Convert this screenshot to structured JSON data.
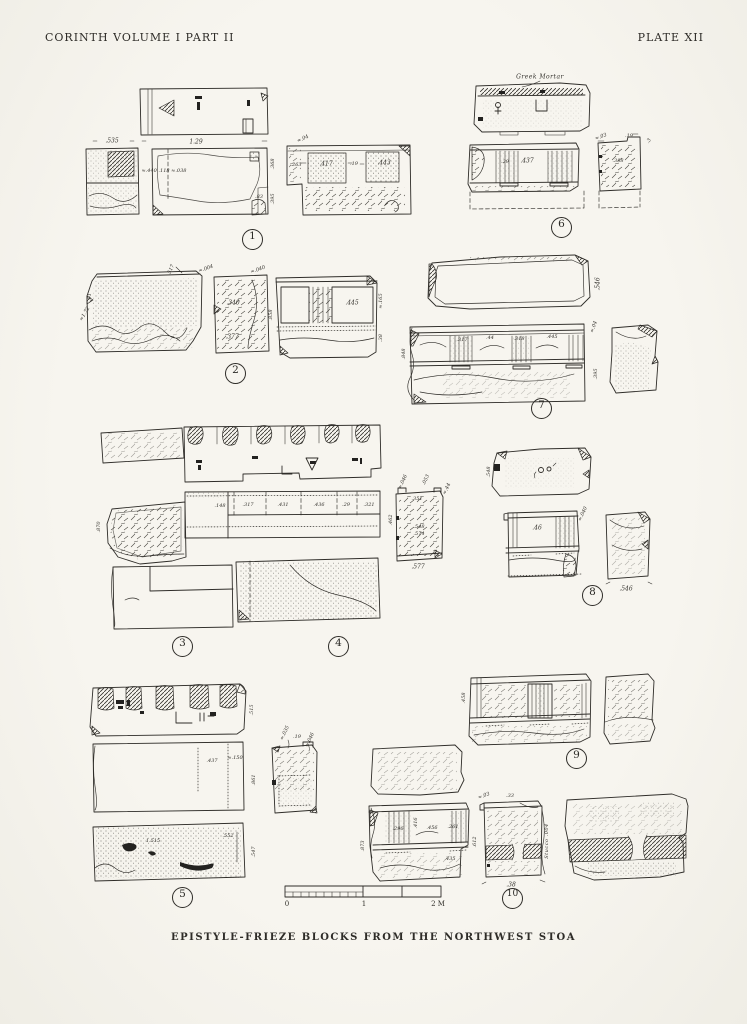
{
  "page": {
    "header_left": "CORINTH   VOLUME I   PART II",
    "header_right": "PLATE XII",
    "caption": "EPISTYLE-FRIEZE BLOCKS FROM THE NORTHWEST STOA"
  },
  "figures": [
    {
      "number": "1",
      "circle": {
        "x": 252,
        "y": 239
      },
      "labels": [
        {
          "t": ".535",
          "x": 112,
          "y": 141
        },
        {
          "t": "1.29",
          "x": 196,
          "y": 142
        },
        {
          "t": "≈.440 .118 ≈.038",
          "x": 164,
          "y": 171,
          "s": 5
        },
        {
          "t": ".83",
          "x": 259,
          "y": 197,
          "s": 5
        },
        {
          "t": ".368",
          "x": 273,
          "y": 164,
          "r": -90,
          "s": 5
        },
        {
          "t": ".395",
          "x": 273,
          "y": 199,
          "r": -90,
          "s": 5
        },
        {
          "t": "≈.04",
          "x": 303,
          "y": 139,
          "r": -25,
          "s": 5
        },
        {
          "t": ".263",
          "x": 296,
          "y": 165,
          "s": 5
        },
        {
          "t": ".417",
          "x": 326,
          "y": 164
        },
        {
          "t": ".19",
          "x": 354,
          "y": 164,
          "s": 5
        },
        {
          "t": ".443",
          "x": 384,
          "y": 163
        }
      ]
    },
    {
      "number": "2",
      "circle": {
        "x": 235,
        "y": 373
      },
      "labels": [
        {
          "t": ".517",
          "x": 171,
          "y": 270,
          "r": -65,
          "s": 5
        },
        {
          "t": ".91",
          "x": 90,
          "y": 297,
          "r": -90,
          "s": 5
        },
        {
          "t": "≈1.72",
          "x": 85,
          "y": 314,
          "r": -60,
          "s": 5
        },
        {
          "t": "≈.004",
          "x": 206,
          "y": 269,
          "r": -20,
          "s": 5
        },
        {
          "t": "≈.040",
          "x": 258,
          "y": 270,
          "r": -20,
          "s": 5
        },
        {
          "t": ".340",
          "x": 233,
          "y": 303
        },
        {
          "t": ".377",
          "x": 232,
          "y": 337
        },
        {
          "t": ".445",
          "x": 352,
          "y": 303
        },
        {
          "t": ".858",
          "x": 271,
          "y": 315,
          "r": -90,
          "s": 5
        },
        {
          "t": "≈.165",
          "x": 381,
          "y": 301,
          "r": -90,
          "s": 5
        },
        {
          "t": ".38",
          "x": 381,
          "y": 338,
          "r": -90,
          "s": 5
        }
      ]
    },
    {
      "number": "3",
      "circle": {
        "x": 182,
        "y": 646
      },
      "labels": [
        {
          "t": ".148",
          "x": 220,
          "y": 506,
          "s": 5
        },
        {
          "t": ".317",
          "x": 248,
          "y": 505,
          "s": 5
        },
        {
          "t": ".431",
          "x": 283,
          "y": 505,
          "s": 5
        },
        {
          "t": ".436",
          "x": 319,
          "y": 505,
          "s": 5
        },
        {
          "t": ".29",
          "x": 346,
          "y": 505,
          "s": 5
        },
        {
          "t": ".321",
          "x": 369,
          "y": 505,
          "s": 5
        },
        {
          "t": ".870",
          "x": 99,
          "y": 527,
          "r": -90,
          "s": 5
        }
      ]
    },
    {
      "number": "4",
      "circle": {
        "x": 338,
        "y": 646
      },
      "labels": [
        {
          "t": "≈.046",
          "x": 403,
          "y": 482,
          "r": -65,
          "s": 5
        },
        {
          "t": ".053",
          "x": 426,
          "y": 480,
          "r": -65,
          "s": 5
        },
        {
          "t": "≈.44",
          "x": 447,
          "y": 489,
          "r": -65,
          "s": 5
        },
        {
          "t": ".351",
          "x": 417,
          "y": 499,
          "s": 5
        },
        {
          "t": ".548",
          "x": 419,
          "y": 527,
          "s": 5
        },
        {
          "t": ".574",
          "x": 419,
          "y": 534,
          "s": 5
        },
        {
          "t": ".462",
          "x": 391,
          "y": 520,
          "r": -90,
          "s": 5
        },
        {
          "t": ".577",
          "x": 418,
          "y": 567
        }
      ]
    },
    {
      "number": "5",
      "circle": {
        "x": 182,
        "y": 897
      },
      "labels": [
        {
          "t": ".515",
          "x": 252,
          "y": 710,
          "r": -90,
          "s": 5
        },
        {
          "t": ".437",
          "x": 212,
          "y": 761,
          "s": 5
        },
        {
          "t": "≈.150",
          "x": 235,
          "y": 758,
          "s": 5
        },
        {
          "t": ".861",
          "x": 254,
          "y": 780,
          "r": -90,
          "s": 5
        },
        {
          "t": "1.515",
          "x": 153,
          "y": 841,
          "s": 5
        },
        {
          "t": ".552",
          "x": 228,
          "y": 836,
          "s": 5
        },
        {
          "t": ".547",
          "x": 254,
          "y": 852,
          "r": -90,
          "s": 5
        },
        {
          "t": "≈.035",
          "x": 285,
          "y": 733,
          "r": -65,
          "s": 5
        },
        {
          "t": ".19",
          "x": 297,
          "y": 737,
          "s": 5
        },
        {
          "t": "≈.046",
          "x": 310,
          "y": 740,
          "r": -65,
          "s": 5
        }
      ]
    },
    {
      "number": "6",
      "circle": {
        "x": 561,
        "y": 227
      },
      "labels": [
        {
          "t": "Greek Mortar",
          "x": 540,
          "y": 77,
          "s": 6,
          "c": "cursive"
        },
        {
          "t": ".29",
          "x": 505,
          "y": 162,
          "s": 5
        },
        {
          "t": ".437",
          "x": 527,
          "y": 161
        },
        {
          "t": "≈.03",
          "x": 601,
          "y": 137,
          "r": -20,
          "s": 5
        },
        {
          "t": ".19",
          "x": 629,
          "y": 136,
          "s": 5
        },
        {
          "t": ".3",
          "x": 649,
          "y": 141,
          "r": -60,
          "s": 5
        },
        {
          "t": ".388",
          "x": 618,
          "y": 161,
          "s": 5
        }
      ]
    },
    {
      "number": "7",
      "circle": {
        "x": 541,
        "y": 408
      },
      "labels": [
        {
          "t": ".546",
          "x": 598,
          "y": 284,
          "r": -90
        },
        {
          "t": ".317",
          "x": 462,
          "y": 340,
          "s": 5
        },
        {
          "t": ".44",
          "x": 490,
          "y": 338,
          "s": 5
        },
        {
          "t": ".318",
          "x": 519,
          "y": 339,
          "s": 5
        },
        {
          "t": ".445",
          "x": 552,
          "y": 337,
          "s": 5
        },
        {
          "t": ".848",
          "x": 404,
          "y": 354,
          "r": -90,
          "s": 5
        },
        {
          "t": "≈.04",
          "x": 594,
          "y": 327,
          "r": -70,
          "s": 5
        },
        {
          "t": ".395",
          "x": 596,
          "y": 374,
          "r": -90,
          "s": 5
        }
      ]
    },
    {
      "number": "8",
      "circle": {
        "x": 592,
        "y": 595
      },
      "labels": [
        {
          "t": ".548",
          "x": 489,
          "y": 472,
          "r": -90,
          "s": 5
        },
        {
          "t": ".46",
          "x": 537,
          "y": 528
        },
        {
          "t": "≈.040",
          "x": 583,
          "y": 514,
          "r": -65,
          "s": 5
        },
        {
          "t": ".546",
          "x": 626,
          "y": 589
        }
      ]
    },
    {
      "number": "9",
      "circle": {
        "x": 576,
        "y": 758
      },
      "labels": [
        {
          "t": ".458",
          "x": 464,
          "y": 698,
          "r": -90,
          "s": 5
        }
      ]
    },
    {
      "number": "10",
      "circle": {
        "x": 512,
        "y": 898
      },
      "labels": [
        {
          "t": ".296",
          "x": 398,
          "y": 829,
          "s": 5
        },
        {
          "t": ".416",
          "x": 416,
          "y": 823,
          "r": -90,
          "s": 5
        },
        {
          "t": ".456",
          "x": 432,
          "y": 828,
          "s": 5
        },
        {
          "t": ".261",
          "x": 453,
          "y": 827,
          "s": 5
        },
        {
          "t": ".873",
          "x": 363,
          "y": 846,
          "r": -90,
          "s": 5
        },
        {
          "t": ".435",
          "x": 450,
          "y": 859,
          "s": 5
        },
        {
          "t": "≈.03",
          "x": 484,
          "y": 796,
          "r": -20,
          "s": 5
        },
        {
          "t": ".33",
          "x": 510,
          "y": 796,
          "s": 5
        },
        {
          "t": ".612",
          "x": 475,
          "y": 842,
          "r": -90,
          "s": 5
        },
        {
          "t": "Stucco .004",
          "x": 547,
          "y": 841,
          "r": -90,
          "s": 5,
          "c": "cursive"
        },
        {
          "t": ".38",
          "x": 511,
          "y": 885
        }
      ]
    }
  ],
  "scale_bar": {
    "labels": [
      {
        "t": "0",
        "x": 287,
        "y": 904,
        "s": 7,
        "c": "upright"
      },
      {
        "t": "1",
        "x": 364,
        "y": 904,
        "s": 7,
        "c": "upright"
      },
      {
        "t": "2 M",
        "x": 438,
        "y": 904,
        "s": 7,
        "c": "upright"
      }
    ]
  }
}
